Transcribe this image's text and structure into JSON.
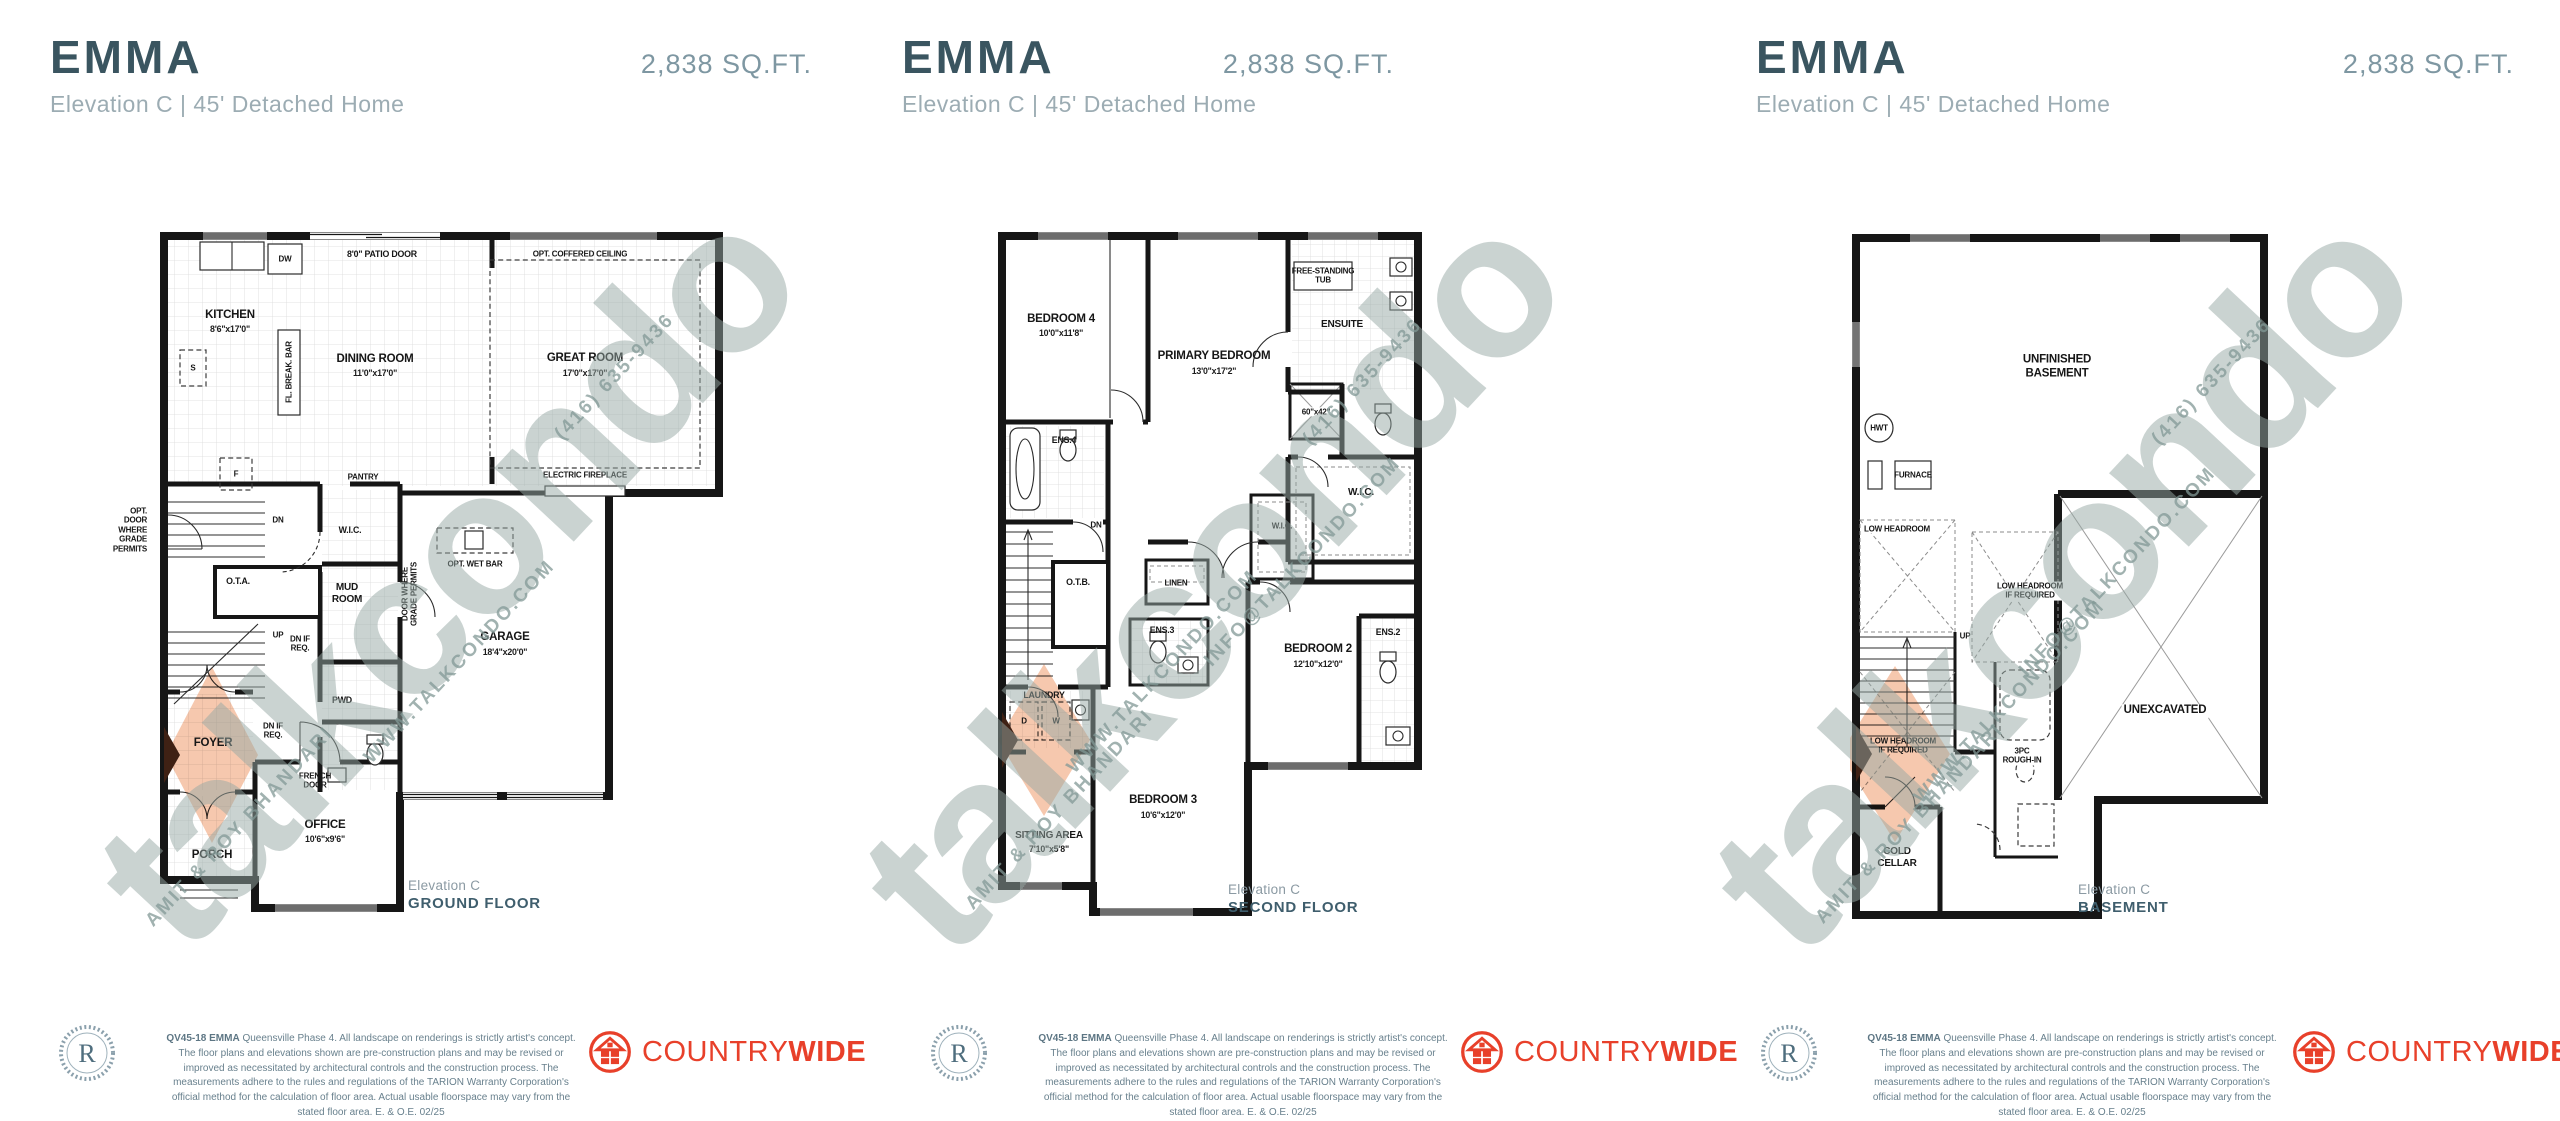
{
  "panels": [
    {
      "title": "EMMA",
      "sqft": "2,838 SQ.FT.",
      "subtitle": "Elevation C  |  45' Detached Home",
      "caption": {
        "elevation": "Elevation C",
        "floor": "GROUND FLOOR"
      },
      "labels": {
        "patio_door": "8'0\" PATIO DOOR",
        "coffered": "OPT. COFFERED CEILING",
        "kitchen": "KITCHEN",
        "kitchen_dims": "8'6\"x17'0\"",
        "dining": "DINING ROOM",
        "dining_dims": "11'0\"x17'0\"",
        "great": "GREAT ROOM",
        "great_dims": "17'0\"x17'0\"",
        "break_bar": "FL. BREAK. BAR",
        "dw": "DW",
        "fridge": "F",
        "sink": "S",
        "pantry": "PANTRY",
        "fireplace": "ELECTRIC FIREPLACE",
        "wic": "W.I.C.",
        "mud_room": "MUD\nROOM",
        "ota": "O.T.A.",
        "dn": "DN",
        "up": "UP",
        "dn_if_req": "DN IF\nREQ.",
        "wet_bar": "OPT. WET BAR",
        "garage": "GARAGE",
        "garage_dims": "18'4\"x20'0\"",
        "door_grade": "DOOR WHERE\nGRADE PERMITS",
        "opt_door_grade": "OPT.\nDOOR\nWHERE\nGRADE\nPERMITS",
        "pwd": "PWD",
        "foyer": "FOYER",
        "french_door": "FRENCH\nDOOR",
        "office": "OFFICE",
        "office_dims": "10'6\"x9'6\"",
        "porch": "PORCH"
      }
    },
    {
      "title": "EMMA",
      "sqft": "2,838 SQ.FT.",
      "subtitle": "Elevation C  |  45' Detached Home",
      "caption": {
        "elevation": "Elevation C",
        "floor": "SECOND FLOOR"
      },
      "labels": {
        "bedroom4": "BEDROOM 4",
        "bedroom4_dims": "10'0\"x11'8\"",
        "primary": "PRIMARY BEDROOM",
        "primary_dims": "13'0\"x17'2\"",
        "tub": "FREE-STANDING\nTUB",
        "ensuite": "ENSUITE",
        "shower": "60\"x42\"",
        "ens4": "ENS.4",
        "wic": "W.I.C.",
        "otb": "O.T.B.",
        "dn": "DN",
        "linen": "LINEN",
        "ens3": "ENS.3",
        "laundry": "LAUNDRY",
        "d": "D",
        "w": "W",
        "bedroom2": "BEDROOM 2",
        "bedroom2_dims": "12'10\"x12'0\"",
        "ens2": "ENS.2",
        "bedroom3": "BEDROOM 3",
        "bedroom3_dims": "10'6\"x12'0\"",
        "sitting": "SITTING AREA",
        "sitting_dims": "7'10\"x5'8\""
      }
    },
    {
      "title": "EMMA",
      "sqft": "2,838 SQ.FT.",
      "subtitle": "Elevation C  |  45' Detached Home",
      "caption": {
        "elevation": "Elevation C",
        "floor": "BASEMENT"
      },
      "labels": {
        "unfinished": "UNFINISHED\nBASEMENT",
        "hwt": "HWT",
        "furnace": "FURNACE",
        "low_headroom": "LOW HEADROOM",
        "low_headroom_req": "LOW HEADROOM\nIF REQUIRED",
        "up": "UP",
        "unexcavated": "UNEXCAVATED",
        "rough_in": "3PC\nROUGH-IN",
        "cold_cellar": "COLD\nCELLAR"
      }
    }
  ],
  "watermark": {
    "brand": "talkcondo",
    "site": "WWW.TALKCONDO.COM",
    "email": "INFO@TALKCONDO.COM",
    "phone": "(416) 635-9436",
    "agents": "AMIT & ROY BHANDARI"
  },
  "footer": {
    "seal_letter": "R",
    "disclaimer_bold": "QV45-18 EMMA",
    "disclaimer": " Queensville Phase 4. All landscape on renderings is strictly artist's concept. The floor plans and elevations shown are pre-construction plans and may be revised or improved as necessitated by architectural controls and the construction process. The measurements adhere to the rules and regulations of the TARION Warranty Corporation's official method for the calculation of floor area. Actual usable floorspace may vary from the stated floor area. E. & O.E. 02/25",
    "brand_regular": "COUNTRY",
    "brand_bold": "WIDE"
  }
}
